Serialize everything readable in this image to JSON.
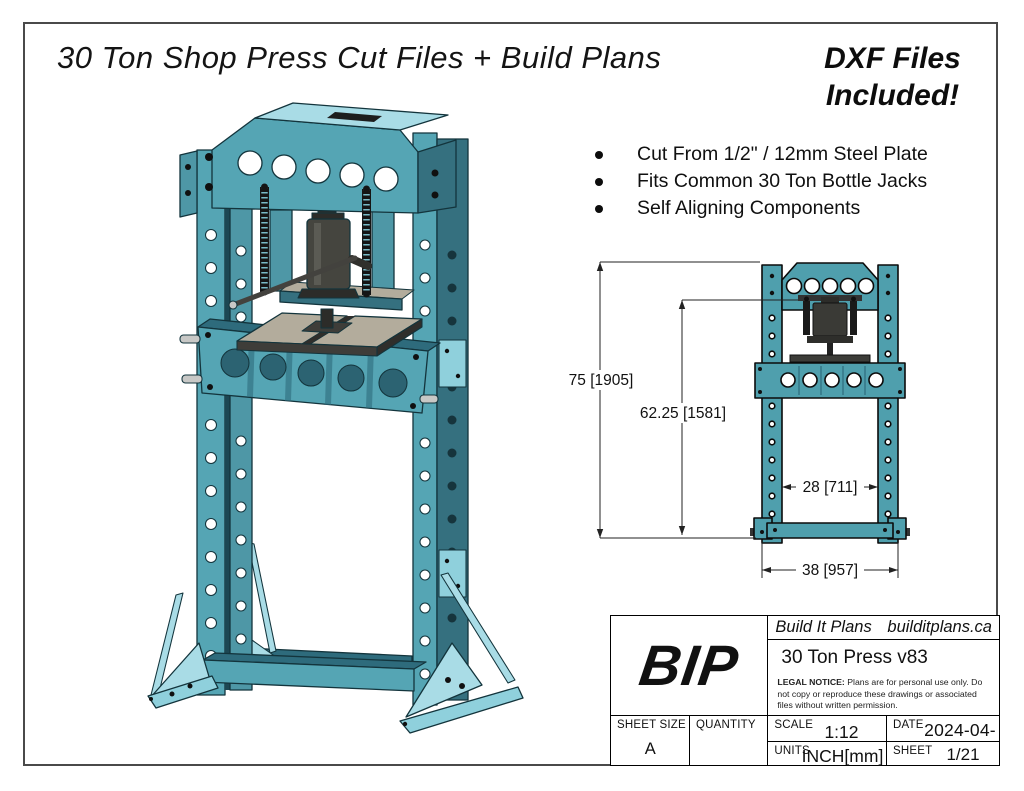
{
  "page": {
    "title": "30 Ton Shop Press Cut Files + Build Plans",
    "promo_line1": "DXF Files",
    "promo_line2": "Included!",
    "bullets": [
      "Cut From 1/2\" / 12mm Steel Plate",
      "Fits Common 30 Ton Bottle Jacks",
      "Self Aligning Components"
    ]
  },
  "drawing": {
    "dims": {
      "height_overall": "75 [1905]",
      "height_working": "62.25 [1581]",
      "width_inside": "28 [711]",
      "width_overall": "38 [957]"
    }
  },
  "title_block": {
    "logo": "BIP",
    "brand": "Build It Plans",
    "website": "builditplans.ca",
    "drawing_name": "30 Ton Press v83",
    "legal_bold": "LEGAL NOTICE:",
    "legal_rest": " Plans are for personal use only. Do not copy or reproduce these drawings or associated files without written permission.",
    "sheet_size_label": "SHEET SIZE",
    "sheet_size_value": "A",
    "quantity_label": "QUANTITY",
    "scale_label": "SCALE",
    "scale_value": "1:12",
    "date_label": "DATE",
    "date_value": "2024-04-09",
    "units_label": "UNITS",
    "units_value": "INCH[mm]",
    "sheet_label": "SHEET",
    "sheet_value": "1/21"
  },
  "colors": {
    "teal_main": "#55a5b4",
    "teal_mid": "#4e97a6",
    "teal_light": "#a9dce6",
    "teal_pale": "#8fd0dc",
    "teal_dark": "#35707f",
    "teal_deep": "#1c4753",
    "teal_shade": "#2e6b7c",
    "outline3d": "#13343c",
    "front_teal": "#4f9fad",
    "jack_gray": "#45453f",
    "jack_dark": "#2c2c29",
    "plate_tan": "#b3ac9c",
    "plate_dark": "#3e3d39",
    "steel_gray": "#c8c8c6"
  }
}
